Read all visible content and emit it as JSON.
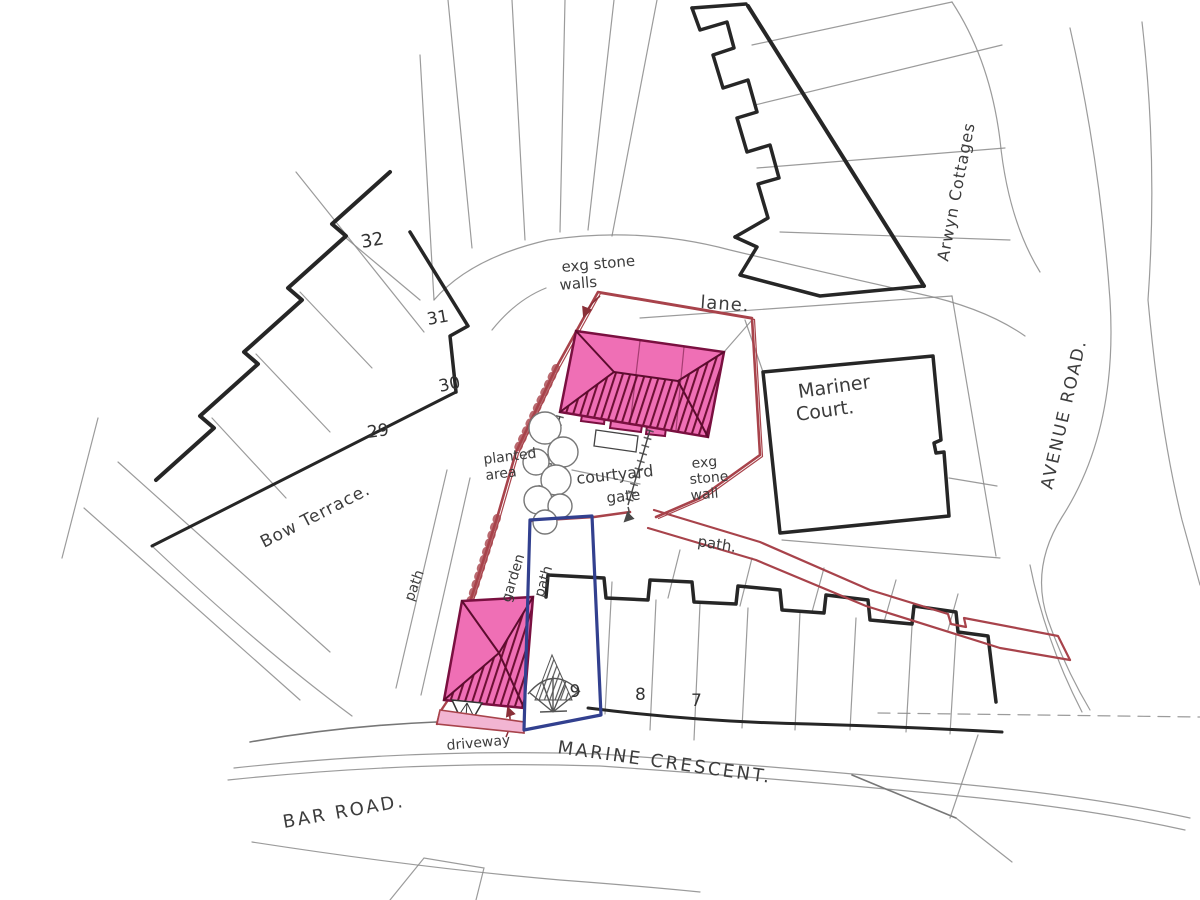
{
  "labels": {
    "exg_stone_walls_line1": "exg stone",
    "exg_stone_walls_line2": "walls",
    "lane": "lane.",
    "arwyn_cottages": "Arwyn Cottages",
    "avenue_road": "AVENUE ROAD.",
    "mariner_court_line1": "Mariner",
    "mariner_court_line2": "Court.",
    "bow_terrace": "Bow Terrace.",
    "planted_area_line1": "planted",
    "planted_area_line2": "area",
    "courtyard": "courtyard",
    "exg_stone_wall_line1": "exg",
    "exg_stone_wall_line2": "stone",
    "exg_stone_wall_line3": "wall",
    "gate": "gate",
    "garden": "garden",
    "path_garden": "path",
    "path_west": "path",
    "path_east": "path.",
    "driveway": "driveway",
    "marine_crescent": "MARINE CRESCENT.",
    "bar_road": "BAR ROAD."
  },
  "numbers": {
    "bow_32": "32",
    "bow_31": "31",
    "bow_30": "30",
    "bow_29": "29",
    "mc_9": "9",
    "mc_8": "8",
    "mc_7": "7"
  },
  "colors": {
    "highlight_pink": "#ef6fb5",
    "boundary_red": "#a8434b",
    "plot_blue": "#32408f",
    "ink": "#262626",
    "pencil": "#8a8a8a"
  }
}
